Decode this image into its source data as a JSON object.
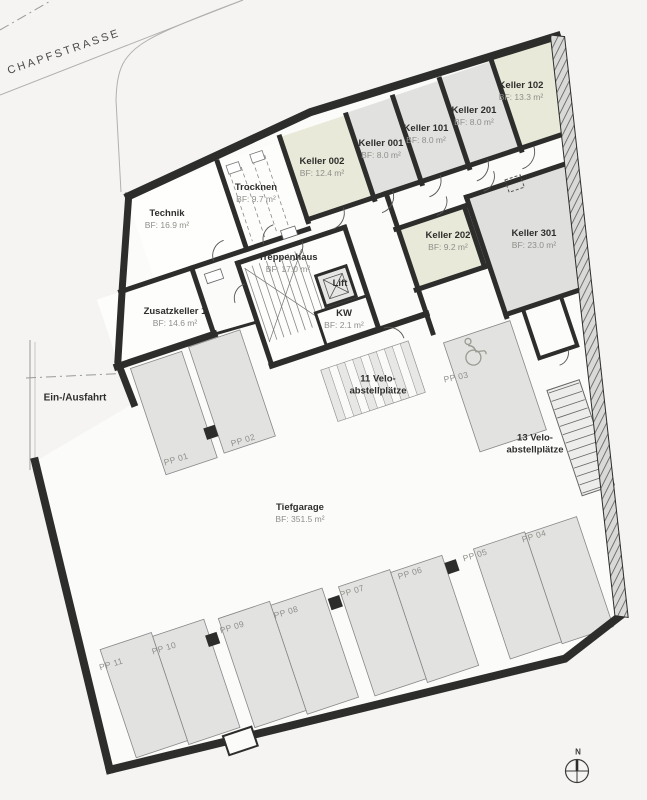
{
  "site": {
    "street": "CHAPFSTRASSE",
    "entry_exit": "Ein-/Ausfahrt",
    "north": "N"
  },
  "rooms": {
    "technik": {
      "name": "Technik",
      "area": "BF: 16.9 m²"
    },
    "trocknen": {
      "name": "Trocknen",
      "area": "BF: 9.7 m²"
    },
    "k002": {
      "name": "Keller 002",
      "area": "BF: 12.4 m²"
    },
    "k001": {
      "name": "Keller 001",
      "area": "BF: 8.0 m²"
    },
    "k101": {
      "name": "Keller 101",
      "area": "BF: 8.0 m²"
    },
    "k201": {
      "name": "Keller 201",
      "area": "BF: 8.0 m²"
    },
    "k102": {
      "name": "Keller 102",
      "area": "BF: 13.3 m²"
    },
    "k202": {
      "name": "Keller 202",
      "area": "BF: 9.2 m²"
    },
    "k301": {
      "name": "Keller 301",
      "area": "BF: 23.0 m²"
    },
    "treppenhaus": {
      "name": "Treppenhaus",
      "area": "BF: 17.0 m²"
    },
    "lift": {
      "name": "Lift"
    },
    "kw": {
      "name": "KW",
      "area": "BF: 2.1 m²"
    },
    "zusatzkeller": {
      "name": "Zusatzkeller 1",
      "area": "BF: 14.6 m²"
    },
    "tiefgarage": {
      "name": "Tiefgarage",
      "area": "BF: 351.5 m²"
    }
  },
  "bike": {
    "b11": {
      "line1": "11 Velo-",
      "line2": "abstellplätze"
    },
    "b13": {
      "line1": "13 Velo-",
      "line2": "abstellplätze"
    }
  },
  "parking": {
    "pp01": "PP 01",
    "pp02": "PP 02",
    "pp03": "PP 03",
    "pp04": "PP 04",
    "pp05": "PP 05",
    "pp06": "PP 06",
    "pp07": "PP 07",
    "pp08": "PP 08",
    "pp09": "PP 09",
    "pp10": "PP 10",
    "pp11": "PP 11"
  },
  "colors": {
    "wall": "#2d2d2b",
    "keller_gray": "#e1e1df",
    "keller_green": "#e8e9d8",
    "stall": "#e2e2e0",
    "background": "#f5f4f2"
  }
}
